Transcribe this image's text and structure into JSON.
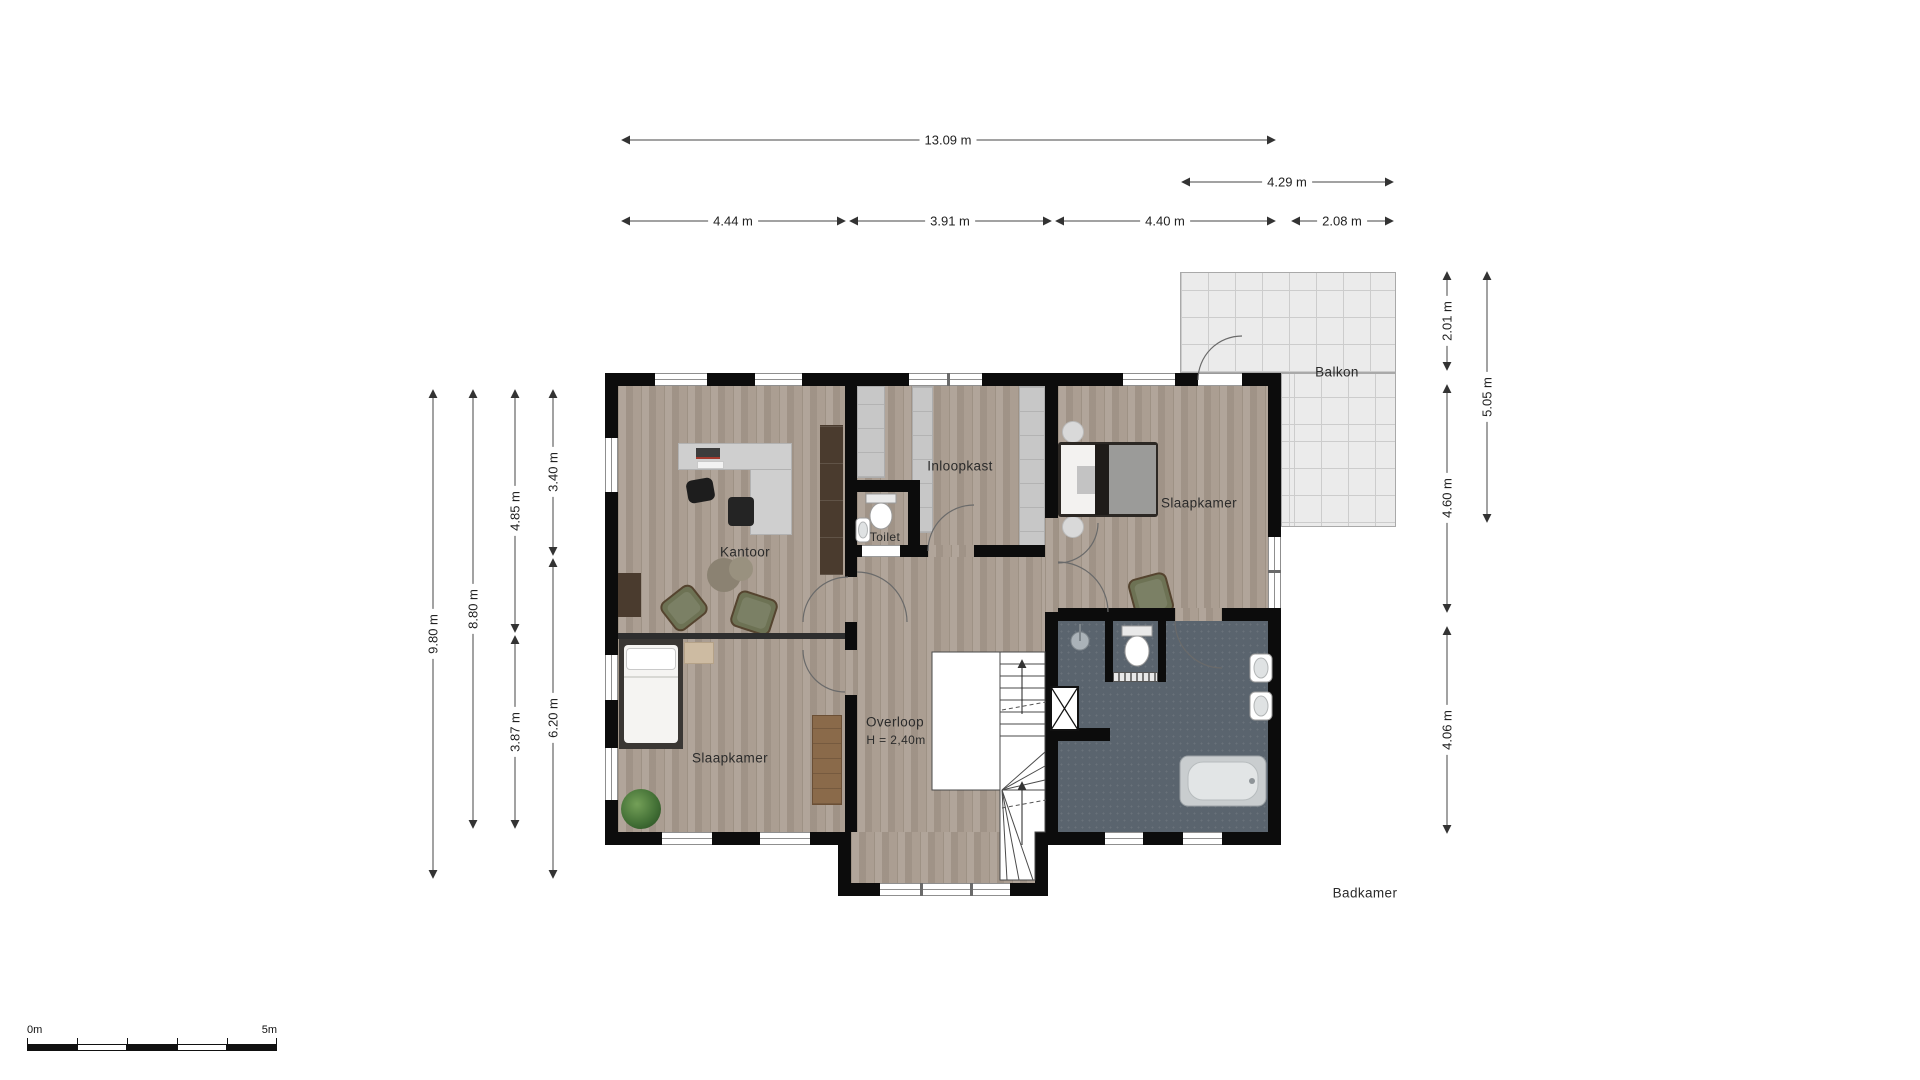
{
  "rooms": {
    "kantoor": "Kantoor",
    "toilet": "Toilet",
    "inloopkast": "Inloopkast",
    "slaapkamer_links": "Slaapkamer",
    "slaapkamer_rechts": "Slaapkamer",
    "overloop": "Overloop",
    "overloop_height": "H = 2,40m",
    "badkamer": "Badkamer",
    "balkon": "Balkon"
  },
  "dimensions": {
    "top_total": "13.09 m",
    "top_balcony": "4.29 m",
    "top_seg1": "4.44 m",
    "top_seg2": "3.91 m",
    "top_seg3": "4.40 m",
    "top_seg4": "2.08 m",
    "left_total": "9.80 m",
    "left_inner": "8.80 m",
    "left_upper": "4.85 m",
    "left_lower": "3.87 m",
    "left_top": "3.40 m",
    "left_bottom": "6.20 m",
    "right_balcony_top": "2.01 m",
    "right_bedroom": "4.60 m",
    "right_bathroom": "4.06 m",
    "right_balcony": "5.05 m"
  },
  "scale_bar": {
    "start_label": "0m",
    "end_label": "5m"
  },
  "colors": {
    "wall": "#0c0c0c",
    "wood_floor": "#a89b8e",
    "bathroom_floor": "#5a646e",
    "balcony": "#ebebeb",
    "wardrobe_gray": "#c7c7c7",
    "armchair_olive": "#6d7254",
    "cabinet_brown": "#4a3b2e",
    "dresser_brown": "#8a6a4a"
  }
}
